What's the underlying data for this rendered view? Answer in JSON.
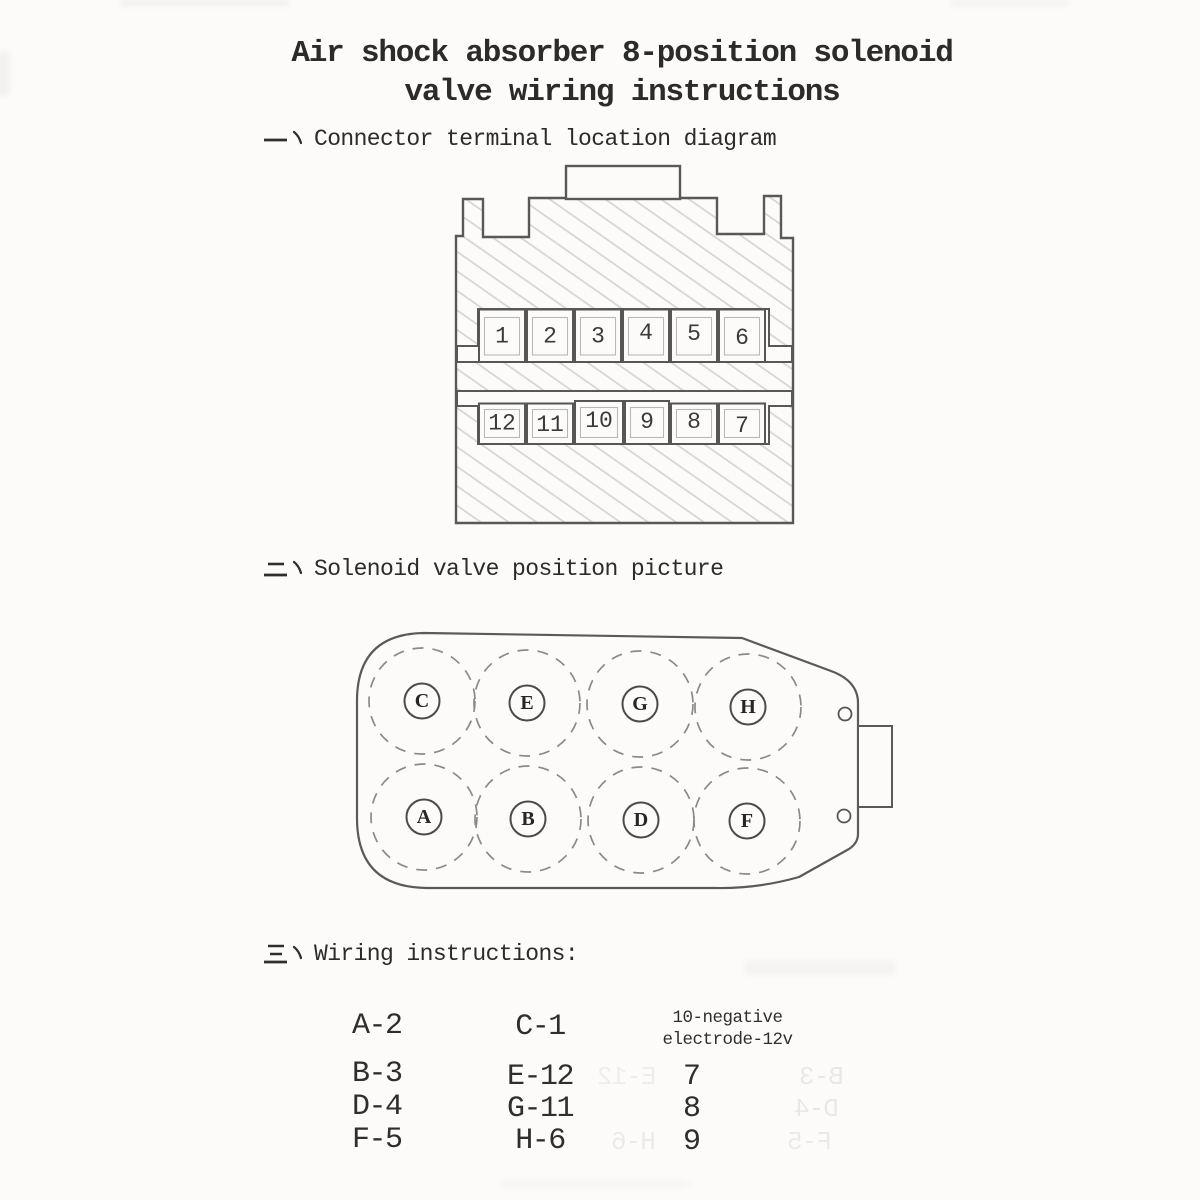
{
  "page": {
    "title_line1": "Air shock absorber 8-position solenoid",
    "title_line2": "valve wiring instructions"
  },
  "sections": {
    "one": {
      "prefix": "一、",
      "label": "Connector terminal location diagram"
    },
    "two": {
      "prefix": "二、",
      "label": "Solenoid valve position picture"
    },
    "three": {
      "prefix": "三、",
      "label": "Wiring instructions:"
    }
  },
  "connector": {
    "top_row": [
      "1",
      "2",
      "3",
      "4",
      "5",
      "6"
    ],
    "bottom_row": [
      "12",
      "11",
      "10",
      "9",
      "8",
      "7"
    ]
  },
  "valve": {
    "top_row": [
      "C",
      "E",
      "G",
      "H"
    ],
    "bottom_row": [
      "A",
      "B",
      "D",
      "F"
    ]
  },
  "wiring": {
    "col1": [
      "A-2",
      "B-3",
      "D-4",
      "F-5"
    ],
    "col2": [
      "C-1",
      "E-12",
      "G-11",
      "H-6"
    ],
    "col3_header_line1": "10-negative",
    "col3_header_line2": "electrode-12v",
    "col3": [
      "7",
      "8",
      "9"
    ]
  },
  "colors": {
    "paper": "#fcfbfa",
    "ink": "#2b2b2b",
    "outline": "#585858",
    "hatch": "#d4d4d4"
  }
}
